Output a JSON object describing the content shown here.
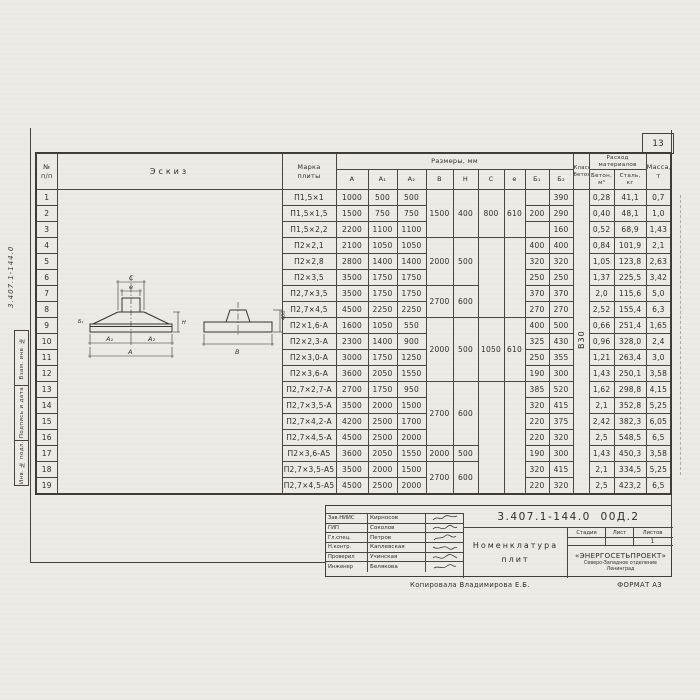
{
  "page_number": "13",
  "left_margin": {
    "doc_number_vertical": "3.407.1-144.0",
    "stamps": [
      {
        "label": "Взам. инв. №"
      },
      {
        "label": "Подпись и дата"
      },
      {
        "label": "Инв. № подл."
      }
    ]
  },
  "table": {
    "col_headers": {
      "num": "№\nп/п",
      "sketch": "Эскиз",
      "mark": "Марка\nплиты",
      "dims_group": "Размеры, мм",
      "dims": [
        "А",
        "А₁",
        "А₂",
        "В",
        "Н",
        "С",
        "е",
        "Б₁",
        "Б₂"
      ],
      "concrete_class": "Класс\nбетона",
      "consumption_group": "Расход\nматериалов",
      "concrete": "Бетон,\nм³",
      "steel": "Сталь,\nкг",
      "mass": "Масса,\nт"
    },
    "concrete_class_value": "В30",
    "merged": {
      "B": [
        {
          "from": 1,
          "to": 3,
          "v": "1500"
        },
        {
          "from": 4,
          "to": 6,
          "v": "2000"
        },
        {
          "from": 7,
          "to": 8,
          "v": "2700"
        },
        {
          "from": 9,
          "to": 12,
          "v": "2000"
        },
        {
          "from": 13,
          "to": 16,
          "v": "2700"
        },
        {
          "from": 17,
          "to": 17,
          "v": "2000"
        },
        {
          "from": 18,
          "to": 19,
          "v": "2700"
        }
      ],
      "H": [
        {
          "from": 1,
          "to": 3,
          "v": "400"
        },
        {
          "from": 4,
          "to": 6,
          "v": "500"
        },
        {
          "from": 7,
          "to": 8,
          "v": "600"
        },
        {
          "from": 9,
          "to": 12,
          "v": "500"
        },
        {
          "from": 13,
          "to": 16,
          "v": "600"
        },
        {
          "from": 17,
          "to": 17,
          "v": "500"
        },
        {
          "from": 18,
          "to": 19,
          "v": "600"
        }
      ],
      "C": [
        {
          "from": 1,
          "to": 3,
          "v": "800"
        },
        {
          "from": 4,
          "to": 8,
          "v": ""
        },
        {
          "from": 9,
          "to": 12,
          "v": "1050"
        },
        {
          "from": 13,
          "to": 19,
          "v": ""
        }
      ],
      "e": [
        {
          "from": 1,
          "to": 3,
          "v": "610"
        },
        {
          "from": 4,
          "to": 8,
          "v": ""
        },
        {
          "from": 9,
          "to": 12,
          "v": "610"
        },
        {
          "from": 13,
          "to": 19,
          "v": ""
        }
      ]
    },
    "rows": [
      {
        "n": "1",
        "mark": "П1,5×1",
        "a": "1000",
        "a1": "500",
        "a2": "500",
        "b1": "",
        "b2": "390",
        "concrete": "0,28",
        "steel": "41,1",
        "mass": "0,7"
      },
      {
        "n": "2",
        "mark": "П1,5×1,5",
        "a": "1500",
        "a1": "750",
        "a2": "750",
        "b1": "200",
        "b2": "290",
        "concrete": "0,40",
        "steel": "48,1",
        "mass": "1,0"
      },
      {
        "n": "3",
        "mark": "П1,5×2,2",
        "a": "2200",
        "a1": "1100",
        "a2": "1100",
        "b1": "",
        "b2": "160",
        "concrete": "0,52",
        "steel": "68,9",
        "mass": "1,43"
      },
      {
        "n": "4",
        "mark": "П2×2,1",
        "a": "2100",
        "a1": "1050",
        "a2": "1050",
        "b1": "400",
        "b2": "400",
        "concrete": "0,84",
        "steel": "101,9",
        "mass": "2,1"
      },
      {
        "n": "5",
        "mark": "П2×2,8",
        "a": "2800",
        "a1": "1400",
        "a2": "1400",
        "b1": "320",
        "b2": "320",
        "concrete": "1,05",
        "steel": "123,8",
        "mass": "2,63"
      },
      {
        "n": "6",
        "mark": "П2×3,5",
        "a": "3500",
        "a1": "1750",
        "a2": "1750",
        "b1": "250",
        "b2": "250",
        "concrete": "1,37",
        "steel": "225,5",
        "mass": "3,42"
      },
      {
        "n": "7",
        "mark": "П2,7×3,5",
        "a": "3500",
        "a1": "1750",
        "a2": "1750",
        "b1": "370",
        "b2": "370",
        "concrete": "2,0",
        "steel": "115,6",
        "mass": "5,0"
      },
      {
        "n": "8",
        "mark": "П2,7×4,5",
        "a": "4500",
        "a1": "2250",
        "a2": "2250",
        "b1": "270",
        "b2": "270",
        "concrete": "2,52",
        "steel": "155,4",
        "mass": "6,3"
      },
      {
        "n": "9",
        "mark": "П2×1,6-А",
        "a": "1600",
        "a1": "1050",
        "a2": "550",
        "b1": "400",
        "b2": "500",
        "concrete": "0,66",
        "steel": "251,4",
        "mass": "1,65"
      },
      {
        "n": "10",
        "mark": "П2×2,3-А",
        "a": "2300",
        "a1": "1400",
        "a2": "900",
        "b1": "325",
        "b2": "430",
        "concrete": "0,96",
        "steel": "328,0",
        "mass": "2,4"
      },
      {
        "n": "11",
        "mark": "П2×3,0-А",
        "a": "3000",
        "a1": "1750",
        "a2": "1250",
        "b1": "250",
        "b2": "355",
        "concrete": "1,21",
        "steel": "263,4",
        "mass": "3,0"
      },
      {
        "n": "12",
        "mark": "П2×3,6-А",
        "a": "3600",
        "a1": "2050",
        "a2": "1550",
        "b1": "190",
        "b2": "300",
        "concrete": "1,43",
        "steel": "250,1",
        "mass": "3,58"
      },
      {
        "n": "13",
        "mark": "П2,7×2,7-А",
        "a": "2700",
        "a1": "1750",
        "a2": "950",
        "b1": "385",
        "b2": "520",
        "concrete": "1,62",
        "steel": "298,8",
        "mass": "4,15"
      },
      {
        "n": "14",
        "mark": "П2,7×3,5-А",
        "a": "3500",
        "a1": "2000",
        "a2": "1500",
        "b1": "320",
        "b2": "415",
        "concrete": "2,1",
        "steel": "352,8",
        "mass": "5,25"
      },
      {
        "n": "15",
        "mark": "П2,7×4,2-А",
        "a": "4200",
        "a1": "2500",
        "a2": "1700",
        "b1": "220",
        "b2": "375",
        "concrete": "2,42",
        "steel": "382,3",
        "mass": "6,05"
      },
      {
        "n": "16",
        "mark": "П2,7×4,5-А",
        "a": "4500",
        "a1": "2500",
        "a2": "2000",
        "b1": "220",
        "b2": "320",
        "concrete": "2,5",
        "steel": "548,5",
        "mass": "6,5"
      },
      {
        "n": "17",
        "mark": "П2×3,6-А5",
        "a": "3600",
        "a1": "2050",
        "a2": "1550",
        "b1": "190",
        "b2": "300",
        "concrete": "1,43",
        "steel": "450,3",
        "mass": "3,58"
      },
      {
        "n": "18",
        "mark": "П2,7×3,5-А5",
        "a": "3500",
        "a1": "2000",
        "a2": "1500",
        "b1": "320",
        "b2": "415",
        "concrete": "2,1",
        "steel": "334,5",
        "mass": "5,25"
      },
      {
        "n": "19",
        "mark": "П2,7×4,5-А5",
        "a": "4500",
        "a1": "2500",
        "a2": "2000",
        "b1": "220",
        "b2": "320",
        "concrete": "2,5",
        "steel": "423,2",
        "mass": "6,5"
      }
    ]
  },
  "sketch_labels": {
    "c": "С",
    "e": "е",
    "a1": "А₁",
    "a2": "А₂",
    "a": "А",
    "h": "Н",
    "b2": "Б₂",
    "b": "В",
    "side_height": "400"
  },
  "title_block": {
    "doc_number": "3.407.1-144.0  00Д.2",
    "people": [
      {
        "role": "Зав.НИИС",
        "name": "Кирносов"
      },
      {
        "role": "ГИП",
        "name": "Соколов"
      },
      {
        "role": "Гл.спец.",
        "name": "Петров"
      },
      {
        "role": "Н.контр.",
        "name": "Каплевская"
      },
      {
        "role": "Проверил",
        "name": "Учинская"
      },
      {
        "role": "Инженер",
        "name": "Белякова"
      }
    ],
    "title_line1": "Номенклатура",
    "title_line2": "плит",
    "stage_label": "Стадия",
    "sheet_label": "Лист",
    "sheets_label": "Листов",
    "sheets_value": "1",
    "org_name": "«ЭНЕРГОСЕТЬПРОЕКТ»",
    "org_line2": "Северо-Западное отделение",
    "org_line3": "Ленинград",
    "footer_copied": "Копировала Владимирова Е.Б.",
    "footer_format": "ФОРМАТ А3"
  }
}
